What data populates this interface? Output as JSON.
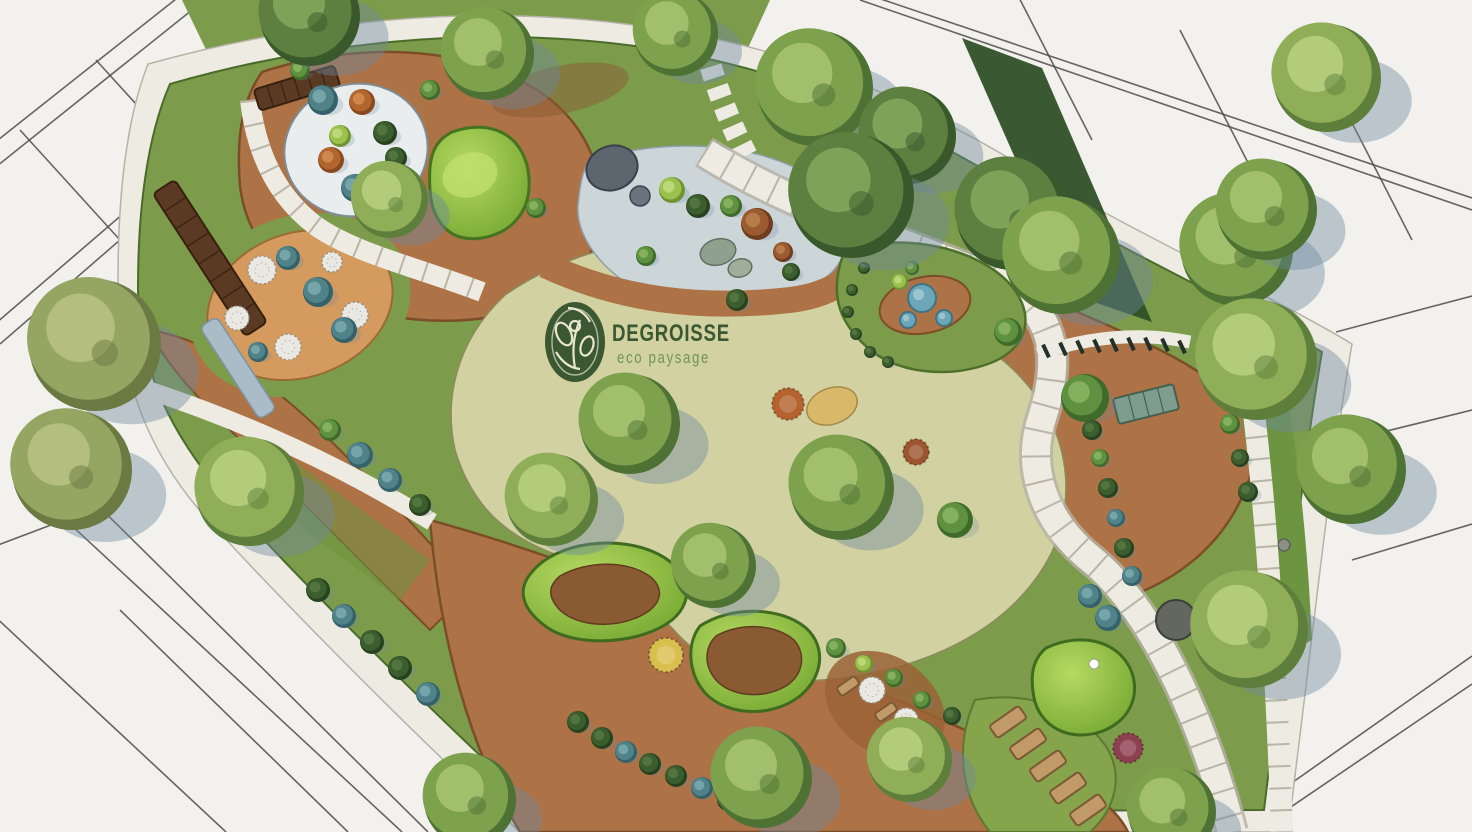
{
  "brand": {
    "name": "DEGROISSE",
    "tagline": "eco paysage"
  },
  "palette": {
    "sketch_bg": "#f2f1ed",
    "sketch_line": "#4b4b49",
    "walk": "#edebe2",
    "walk_edge": "#b5b2a6",
    "lawn": "#7d9c4b",
    "lawn_dark": "#5e8038",
    "lawn_pale": "#d2d1a2",
    "lawn_pale_edge": "#8d8a5c",
    "mulch": "#ad7245",
    "mulch_dark": "#7c4e28",
    "soil": "#8a5a33",
    "sand": "#d49a5e",
    "plaza": "#ccd5d8",
    "gravel_blue": "#a9bcc8",
    "wood": "#5a3a22",
    "wood_line": "#38200f",
    "water": "#6ba7b8",
    "water_dark": "#3f7484",
    "stone_gray": "#5c666e",
    "white_circle": "#e9edee",
    "verge": "#6d9440",
    "hedge_dark": "#2f4f27",
    "mound_hi": "#b6da62",
    "mound_lo": "#76a832",
    "shadow": "rgba(110,136,160,0.42)",
    "logo": "#3c5833",
    "logo_sub": "#6f9556",
    "logo_pale": "#e7e7cf"
  },
  "scene": {
    "sketch_lines": [
      [
        -40,
        170,
        200,
        -20
      ],
      [
        -28,
        186,
        212,
        -6
      ],
      [
        -12,
        330,
        246,
        108
      ],
      [
        0,
        344,
        256,
        122
      ],
      [
        96,
        60,
        196,
        170
      ],
      [
        20,
        130,
        120,
        240
      ],
      [
        64,
        472,
        428,
        832
      ],
      [
        42,
        498,
        402,
        832
      ],
      [
        -10,
        612,
        226,
        832
      ],
      [
        120,
        610,
        348,
        832
      ],
      [
        -10,
        548,
        96,
        508
      ],
      [
        848,
        -12,
        1472,
        198
      ],
      [
        860,
        0,
        1472,
        210
      ],
      [
        1010,
        -20,
        1092,
        140
      ],
      [
        1180,
        30,
        1262,
        190
      ],
      [
        1330,
        80,
        1412,
        240
      ],
      [
        1336,
        332,
        1472,
        296
      ],
      [
        1326,
        446,
        1472,
        410
      ],
      [
        1352,
        560,
        1472,
        524
      ],
      [
        1222,
        832,
        1472,
        656
      ],
      [
        1254,
        832,
        1472,
        684
      ]
    ],
    "trees": [
      [
        310,
        16,
        50,
        "dark"
      ],
      [
        488,
        54,
        46,
        "mid"
      ],
      [
        676,
        34,
        42,
        "mid"
      ],
      [
        815,
        88,
        58,
        "mid"
      ],
      [
        908,
        136,
        48,
        "dark"
      ],
      [
        1012,
        214,
        56,
        "dark"
      ],
      [
        1062,
        256,
        58,
        "mid"
      ],
      [
        1237,
        250,
        56,
        "mid"
      ],
      [
        1327,
        78,
        54,
        "light"
      ],
      [
        1267,
        210,
        50,
        "mid"
      ],
      [
        1257,
        360,
        60,
        "light"
      ],
      [
        1352,
        470,
        54,
        "mid"
      ],
      [
        1250,
        630,
        58,
        "light"
      ],
      [
        1172,
        812,
        44,
        "mid"
      ],
      [
        95,
        345,
        66,
        "olive"
      ],
      [
        72,
        470,
        60,
        "olive"
      ],
      [
        250,
        492,
        54,
        "light"
      ],
      [
        390,
        200,
        38,
        "light"
      ],
      [
        852,
        196,
        62,
        "dark"
      ],
      [
        630,
        424,
        50,
        "mid"
      ],
      [
        552,
        500,
        46,
        "light"
      ],
      [
        714,
        566,
        42,
        "mid"
      ],
      [
        842,
        488,
        52,
        "mid"
      ],
      [
        470,
        800,
        46,
        "mid"
      ],
      [
        762,
        778,
        50,
        "mid"
      ],
      [
        910,
        760,
        42,
        "light"
      ]
    ],
    "shrubs": [
      [
        323,
        100,
        15,
        "teal"
      ],
      [
        362,
        102,
        13,
        "orange"
      ],
      [
        340,
        136,
        11,
        "lime"
      ],
      [
        385,
        133,
        12,
        "dgreen"
      ],
      [
        396,
        158,
        11,
        "dgreen"
      ],
      [
        331,
        160,
        13,
        "orange"
      ],
      [
        355,
        188,
        14,
        "teal"
      ],
      [
        300,
        70,
        10,
        "green"
      ],
      [
        430,
        90,
        10,
        "green"
      ],
      [
        536,
        208,
        10,
        "green"
      ],
      [
        318,
        292,
        15,
        "teal"
      ],
      [
        288,
        258,
        12,
        "teal"
      ],
      [
        344,
        330,
        13,
        "teal"
      ],
      [
        258,
        352,
        10,
        "teal"
      ],
      [
        360,
        455,
        13,
        "teal"
      ],
      [
        390,
        480,
        12,
        "teal"
      ],
      [
        330,
        430,
        11,
        "green"
      ],
      [
        420,
        505,
        11,
        "dgreen"
      ],
      [
        672,
        190,
        13,
        "lime"
      ],
      [
        698,
        206,
        12,
        "dgreen"
      ],
      [
        757,
        224,
        16,
        "rust"
      ],
      [
        783,
        252,
        10,
        "rust"
      ],
      [
        791,
        272,
        9,
        "dgreen"
      ],
      [
        737,
        300,
        11,
        "dgreen"
      ],
      [
        646,
        256,
        10,
        "green"
      ],
      [
        731,
        206,
        11,
        "green"
      ],
      [
        864,
        268,
        6,
        "dgreen"
      ],
      [
        852,
        290,
        6,
        "dgreen"
      ],
      [
        848,
        312,
        6,
        "dgreen"
      ],
      [
        856,
        334,
        6,
        "dgreen"
      ],
      [
        870,
        352,
        6,
        "dgreen"
      ],
      [
        888,
        362,
        6,
        "dgreen"
      ],
      [
        900,
        282,
        8,
        "lime"
      ],
      [
        912,
        268,
        7,
        "green"
      ],
      [
        1085,
        398,
        24,
        "green"
      ],
      [
        955,
        520,
        18,
        "green"
      ],
      [
        1008,
        332,
        14,
        "green"
      ],
      [
        1092,
        430,
        10,
        "dgreen"
      ],
      [
        1100,
        458,
        9,
        "green"
      ],
      [
        1108,
        488,
        10,
        "dgreen"
      ],
      [
        1116,
        518,
        9,
        "teal"
      ],
      [
        1124,
        548,
        10,
        "dgreen"
      ],
      [
        1132,
        576,
        10,
        "teal"
      ],
      [
        1090,
        596,
        12,
        "teal"
      ],
      [
        1108,
        618,
        13,
        "teal"
      ],
      [
        1208,
        362,
        10,
        "dgreen"
      ],
      [
        1220,
        392,
        9,
        "dgreen"
      ],
      [
        1230,
        424,
        10,
        "green"
      ],
      [
        1240,
        458,
        9,
        "dgreen"
      ],
      [
        1248,
        492,
        10,
        "dgreen"
      ],
      [
        578,
        722,
        11,
        "dgreen"
      ],
      [
        602,
        738,
        11,
        "dgreen"
      ],
      [
        626,
        752,
        11,
        "teal"
      ],
      [
        650,
        764,
        11,
        "dgreen"
      ],
      [
        676,
        776,
        11,
        "dgreen"
      ],
      [
        702,
        788,
        11,
        "teal"
      ],
      [
        728,
        800,
        11,
        "dgreen"
      ],
      [
        754,
        812,
        11,
        "dgreen"
      ],
      [
        318,
        590,
        12,
        "dgreen"
      ],
      [
        344,
        616,
        12,
        "teal"
      ],
      [
        372,
        642,
        12,
        "dgreen"
      ],
      [
        400,
        668,
        12,
        "dgreen"
      ],
      [
        428,
        694,
        12,
        "teal"
      ],
      [
        836,
        648,
        10,
        "green"
      ],
      [
        864,
        664,
        9,
        "lime"
      ],
      [
        894,
        678,
        9,
        "green"
      ],
      [
        922,
        700,
        9,
        "green"
      ],
      [
        952,
        716,
        9,
        "dgreen"
      ]
    ],
    "gravel_circles": [
      [
        262,
        270,
        14
      ],
      [
        237,
        318,
        12
      ],
      [
        288,
        347,
        13
      ],
      [
        332,
        262,
        10
      ],
      [
        355,
        315,
        13
      ],
      [
        872,
        690,
        13
      ],
      [
        906,
        720,
        12
      ]
    ],
    "water_circles": [
      [
        922,
        298,
        14
      ],
      [
        944,
        318,
        8
      ],
      [
        908,
        320,
        8
      ]
    ],
    "flower_circles": [
      [
        788,
        404,
        16,
        "#b5622e"
      ],
      [
        916,
        452,
        13,
        "#9c5530"
      ],
      [
        666,
        655,
        17,
        "#d9bf4e"
      ],
      [
        1128,
        748,
        15,
        "#8e4050"
      ]
    ],
    "posts": [
      [
        1046,
        351
      ],
      [
        1063,
        349
      ],
      [
        1080,
        347
      ],
      [
        1097,
        346
      ],
      [
        1114,
        345
      ],
      [
        1131,
        344
      ],
      [
        1148,
        344
      ],
      [
        1165,
        345
      ],
      [
        1182,
        347
      ]
    ],
    "beds": [
      [
        1008,
        722,
        -35,
        36,
        15
      ],
      [
        1028,
        744,
        -35,
        36,
        15
      ],
      [
        1048,
        766,
        -35,
        36,
        15
      ],
      [
        1068,
        788,
        -35,
        36,
        15
      ],
      [
        1088,
        810,
        -35,
        36,
        15
      ],
      [
        848,
        686,
        -35,
        22,
        10
      ],
      [
        886,
        712,
        -35,
        22,
        10
      ]
    ]
  }
}
